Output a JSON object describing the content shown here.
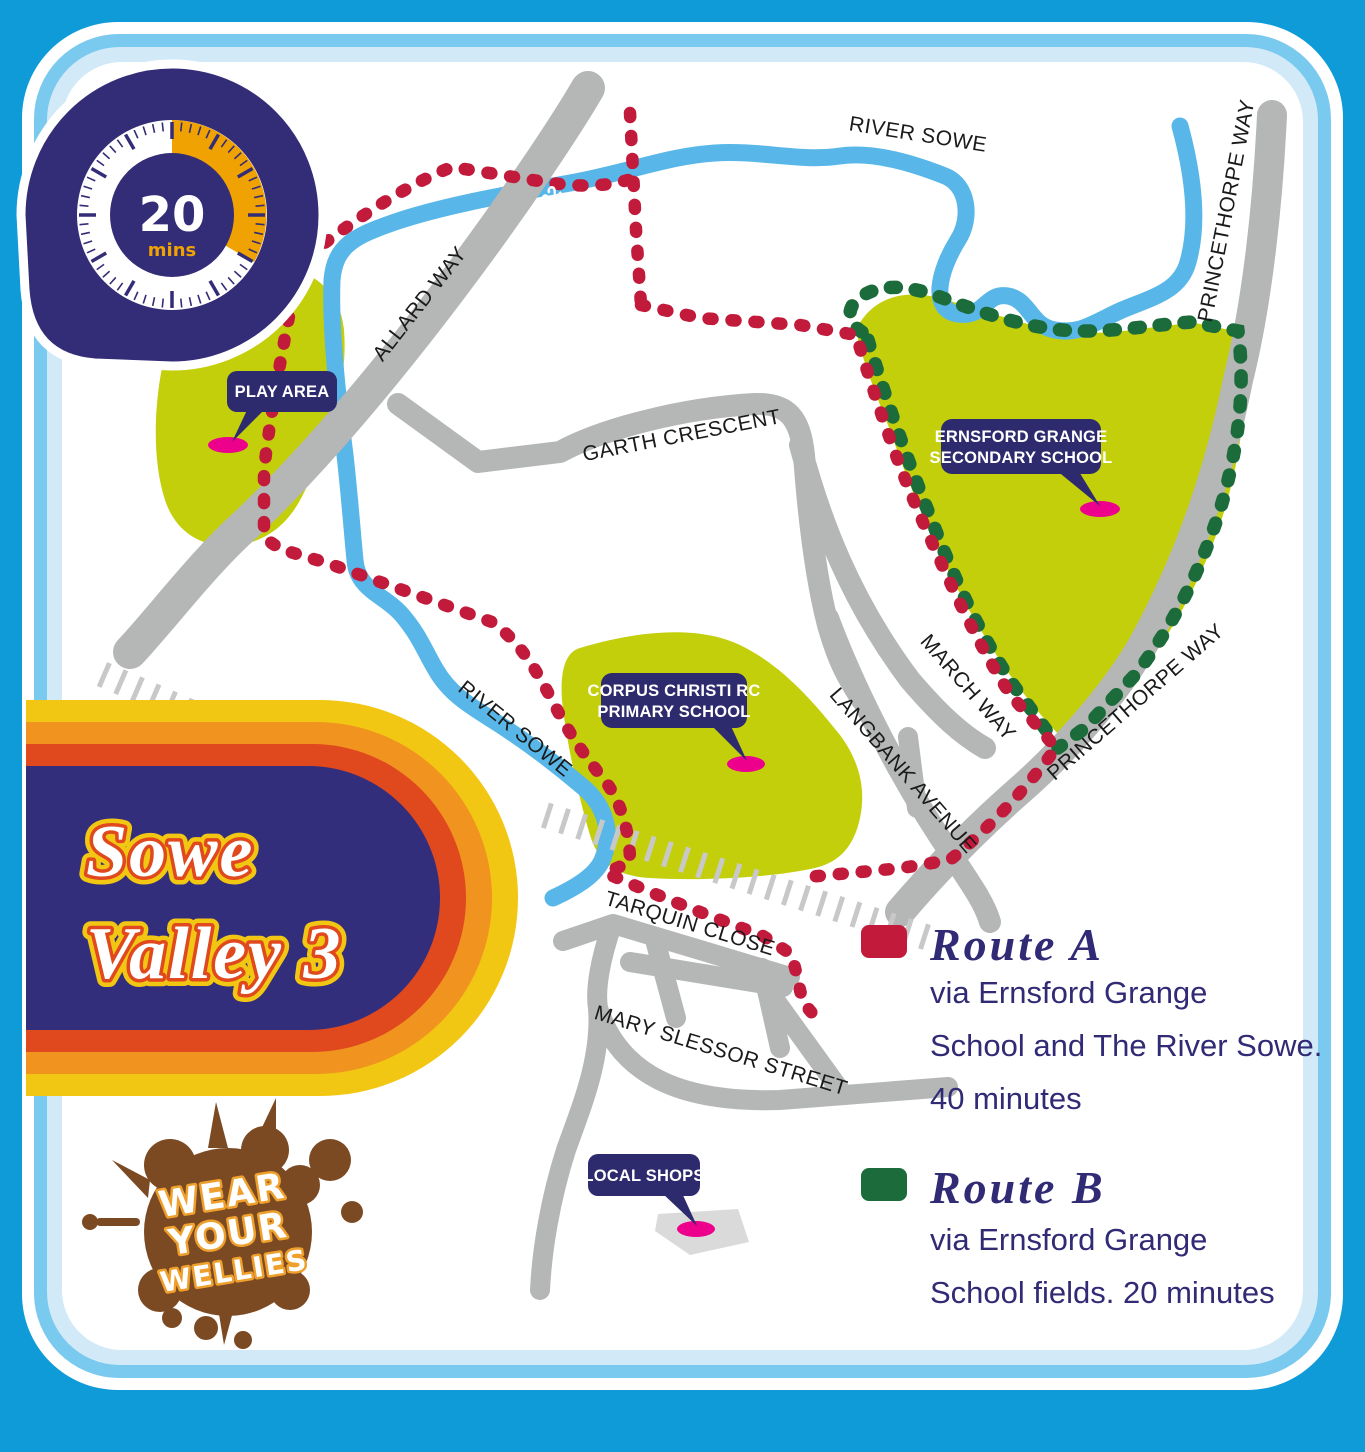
{
  "banner": {
    "line1": "Sowe",
    "line2": "Valley 3"
  },
  "timer": {
    "value": "20",
    "unit": "mins"
  },
  "stamp": {
    "line1": "WEAR",
    "line2": "YOUR",
    "line3": "WELLIES"
  },
  "map": {
    "road_labels": {
      "river_sowe_top": "RIVER SOWE",
      "princethorpe_top": "PRINCETHORPE WAY",
      "allard_way": "ALLARD WAY",
      "a4082": "A4082",
      "garth_crescent": "GARTH CRESCENT",
      "march_way": "MARCH WAY",
      "langbank_avenue": "LANGBANK AVENUE",
      "princethorpe_lower": "PRINCETHORPE WAY",
      "tarquin_close": "TARQUIN CLOSE",
      "mary_slessor_street": "MARY SLESSOR STREET",
      "river_sowe_left": "RIVER SOWE"
    },
    "places": {
      "play_area": "PLAY AREA",
      "school_line1": "ERNSFORD GRANGE",
      "school_line2": "SECONDARY SCHOOL",
      "corpus_line1": "CORPUS CHRISTI RC",
      "corpus_line2": "PRIMARY SCHOOL",
      "local_shops": "LOCAL SHOPS"
    }
  },
  "legend": {
    "route_a": {
      "name": "Route A",
      "line1": "via Ernsford Grange",
      "line2": "School and The River Sowe.",
      "line3": "40 minutes",
      "color": "#C11A3B"
    },
    "route_b": {
      "name": "Route B",
      "line1": "via Ernsford Grange",
      "line2": "School fields. 20 minutes",
      "color": "#1B6B3B"
    }
  },
  "colors": {
    "frame_blue": "#0E9BD8",
    "ring_sky": "#7AC9EE",
    "ring_pale": "#D2EAF8",
    "card": "#FFFFFF",
    "road_gray": "#B5B6B6",
    "river_blue": "#58B7E8",
    "green_space": "#C3CF0B",
    "bubble_navy": "#2E2A6E",
    "marker_pink": "#EC008C",
    "banner_yellow": "#F2C713",
    "banner_orange": "#F0941F",
    "banner_red": "#E0481E",
    "banner_navy": "#322E7C",
    "timer_orange": "#F0A202",
    "mud_brown": "#7B4A23"
  }
}
